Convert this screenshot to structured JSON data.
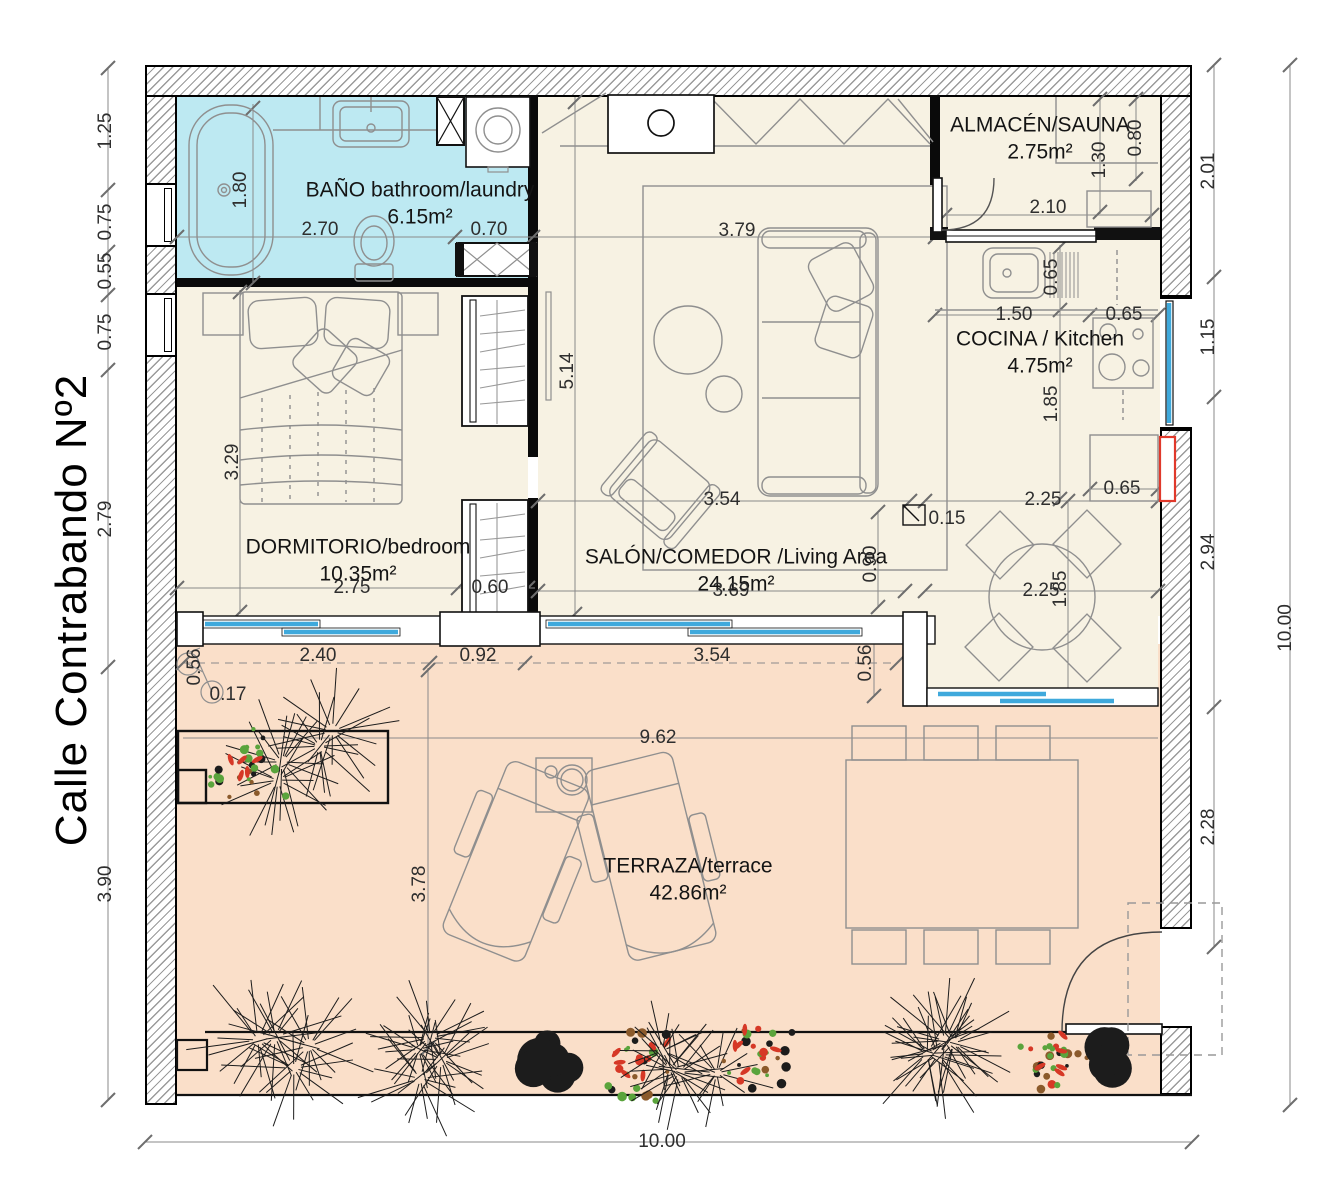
{
  "street": {
    "label": "Calle Contrabando Nº2"
  },
  "rooms": {
    "bano": {
      "name": "BAÑO bathroom/laundry",
      "area": "6.15m²"
    },
    "dormitorio": {
      "name": "DORMITORIO/bedroom",
      "area": "10.35m²"
    },
    "salon": {
      "name": "SALÓN/COMEDOR /Living Area",
      "area": "24.15m²"
    },
    "almacen": {
      "name": "ALMACÉN/SAUNA",
      "area": "2.75m²"
    },
    "cocina": {
      "name": "COCINA / Kitchen",
      "area": "4.75m²"
    },
    "terraza": {
      "name": "TERRAZA/terrace",
      "area": "42.86m²"
    }
  },
  "dimensions": [
    {
      "value": "1.25",
      "x": 106,
      "y": 131,
      "vertical": true
    },
    {
      "value": "0.75",
      "x": 106,
      "y": 222,
      "vertical": true
    },
    {
      "value": "0.55",
      "x": 106,
      "y": 271,
      "vertical": true
    },
    {
      "value": "0.75",
      "x": 106,
      "y": 332,
      "vertical": true
    },
    {
      "value": "2.79",
      "x": 106,
      "y": 519,
      "vertical": true
    },
    {
      "value": "3.90",
      "x": 106,
      "y": 884,
      "vertical": true
    },
    {
      "value": "2.01",
      "x": 1209,
      "y": 171,
      "vertical": true
    },
    {
      "value": "1.15",
      "x": 1209,
      "y": 337,
      "vertical": true
    },
    {
      "value": "2.94",
      "x": 1209,
      "y": 552,
      "vertical": true
    },
    {
      "value": "2.28",
      "x": 1209,
      "y": 827,
      "vertical": true
    },
    {
      "value": "10.00",
      "x": 1286,
      "y": 628,
      "vertical": true
    },
    {
      "value": "10.00",
      "x": 662,
      "y": 1142,
      "vertical": false
    },
    {
      "value": "1.80",
      "x": 241,
      "y": 190,
      "vertical": true
    },
    {
      "value": "2.70",
      "x": 320,
      "y": 230,
      "vertical": false
    },
    {
      "value": "0.70",
      "x": 489,
      "y": 230,
      "vertical": false
    },
    {
      "value": "1.30",
      "x": 1100,
      "y": 160,
      "vertical": true
    },
    {
      "value": "0.80",
      "x": 1136,
      "y": 138,
      "vertical": true
    },
    {
      "value": "2.10",
      "x": 1048,
      "y": 208,
      "vertical": false
    },
    {
      "value": "0.65",
      "x": 1052,
      "y": 277,
      "vertical": true
    },
    {
      "value": "1.50",
      "x": 1014,
      "y": 315,
      "vertical": false
    },
    {
      "value": "0.65",
      "x": 1124,
      "y": 315,
      "vertical": false
    },
    {
      "value": "1.85",
      "x": 1052,
      "y": 404,
      "vertical": true
    },
    {
      "value": "0.65",
      "x": 1122,
      "y": 489,
      "vertical": false
    },
    {
      "value": "2.25",
      "x": 1043,
      "y": 500,
      "vertical": false
    },
    {
      "value": "0.15",
      "x": 947,
      "y": 519,
      "vertical": false
    },
    {
      "value": "3.79",
      "x": 737,
      "y": 231,
      "vertical": false
    },
    {
      "value": "5.14",
      "x": 568,
      "y": 371,
      "vertical": true
    },
    {
      "value": "3.54",
      "x": 722,
      "y": 500,
      "vertical": false
    },
    {
      "value": "3.69",
      "x": 731,
      "y": 591,
      "vertical": false
    },
    {
      "value": "0.90",
      "x": 871,
      "y": 564,
      "vertical": true
    },
    {
      "value": "2.25",
      "x": 1041,
      "y": 591,
      "vertical": false
    },
    {
      "value": "1.85",
      "x": 1061,
      "y": 589,
      "vertical": true
    },
    {
      "value": "3.29",
      "x": 233,
      "y": 462,
      "vertical": true
    },
    {
      "value": "2.75",
      "x": 352,
      "y": 588,
      "vertical": false
    },
    {
      "value": "0.60",
      "x": 490,
      "y": 588,
      "vertical": false
    },
    {
      "value": "0.56",
      "x": 195,
      "y": 667,
      "vertical": true
    },
    {
      "value": "0.17",
      "x": 228,
      "y": 695,
      "vertical": false
    },
    {
      "value": "2.40",
      "x": 318,
      "y": 656,
      "vertical": false
    },
    {
      "value": "0.92",
      "x": 478,
      "y": 656,
      "vertical": false
    },
    {
      "value": "3.54",
      "x": 712,
      "y": 656,
      "vertical": false
    },
    {
      "value": "0.56",
      "x": 866,
      "y": 663,
      "vertical": true
    },
    {
      "value": "9.62",
      "x": 658,
      "y": 738,
      "vertical": false
    },
    {
      "value": "3.78",
      "x": 420,
      "y": 884,
      "vertical": true
    }
  ],
  "colors": {
    "floor_cream": "#f7f2e3",
    "bath_cyan": "#bde9f2",
    "terrace_peach": "#fadfc9",
    "glass_blue": "#3fa9dc",
    "accent_red": "#e0392b",
    "hatch_gray": "#9a9a9a",
    "line_gray": "#8f8f8f",
    "plant_green": "#5aa43c",
    "plant_red": "#d63826",
    "plant_dark": "#1c1c1c"
  }
}
